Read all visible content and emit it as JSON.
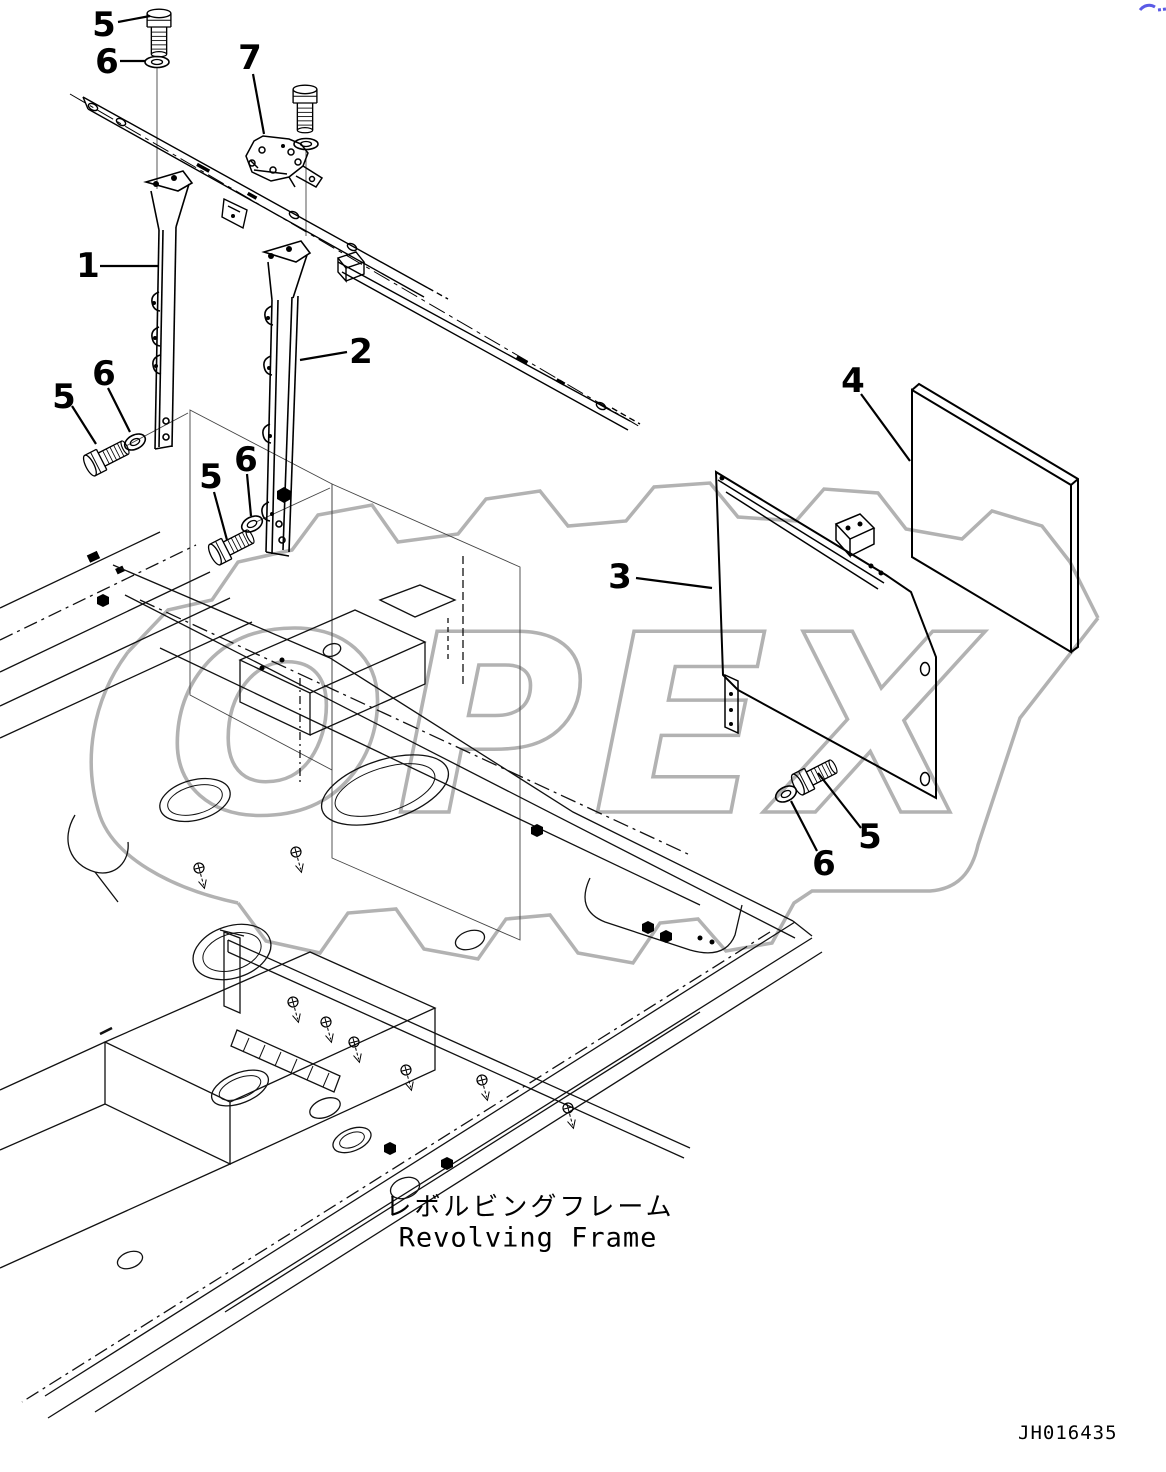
{
  "meta": {
    "watermark_text": "OPEX",
    "drawing_code": "JH016435",
    "line_color": "#000000",
    "watermark_color": "#b2b2b2",
    "accent_blue": "#5a5ae6"
  },
  "title": {
    "ja": "レボルビングフレーム",
    "en": "Revolving Frame"
  },
  "callouts": [
    {
      "label": "5"
    },
    {
      "label": "6"
    },
    {
      "label": "7"
    },
    {
      "label": "1"
    },
    {
      "label": "2"
    },
    {
      "label": "5"
    },
    {
      "label": "6"
    },
    {
      "label": "5"
    },
    {
      "label": "6"
    },
    {
      "label": "3"
    },
    {
      "label": "4"
    },
    {
      "label": "5"
    },
    {
      "label": "6"
    }
  ]
}
